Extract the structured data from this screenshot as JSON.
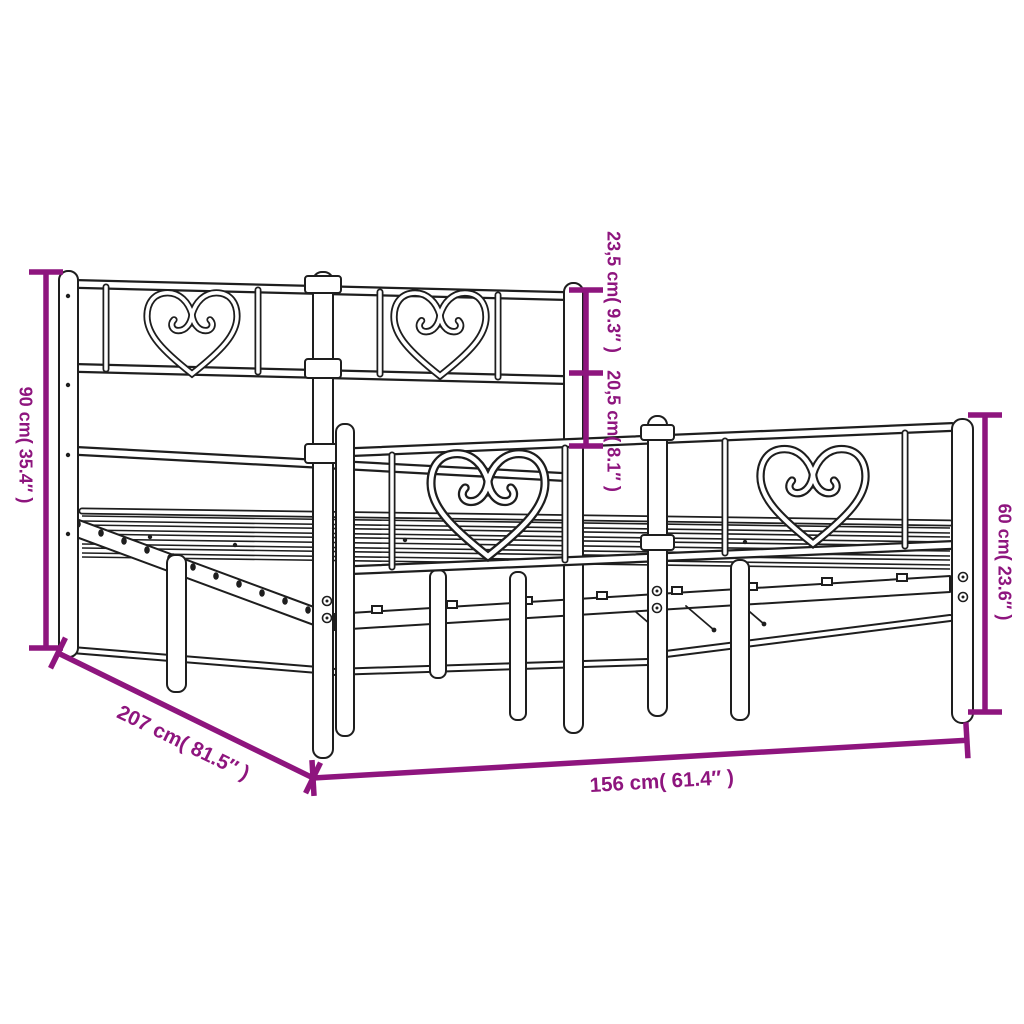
{
  "page": {
    "background": "#ffffff",
    "title": "Metal bed frame dimension diagram"
  },
  "artwork": {
    "line_color": "#1e1e1e",
    "dimension_color": "#8E157E",
    "subject": "metal bed frame with heart-motif headboard and footboard and slatted base",
    "heart_motifs_count": 4
  },
  "dimensions": {
    "headboard_height": {
      "label": "90 cm( 35.4″ )"
    },
    "top_section": {
      "label": "23,5 cm( 9.3″ )"
    },
    "lower_section": {
      "label": "20,5 cm( 8.1″ )"
    },
    "footboard_height": {
      "label": "60 cm( 23.6″ )"
    },
    "length": {
      "label": "207 cm( 81.5″ )"
    },
    "width": {
      "label": "156 cm( 61.4″ )"
    }
  }
}
